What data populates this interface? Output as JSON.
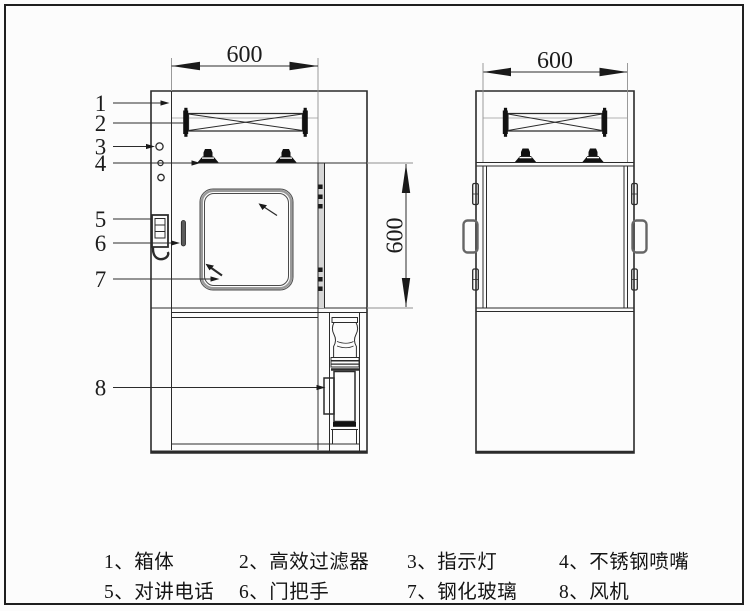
{
  "dimensions": {
    "front_width": "600",
    "front_height": "600",
    "side_width": "600"
  },
  "callouts": [
    "1",
    "2",
    "3",
    "4",
    "5",
    "6",
    "7",
    "8"
  ],
  "legend": {
    "items": [
      "1、箱体",
      "2、高效过滤器",
      "3、指示灯",
      "4、不锈钢喷嘴",
      "5、对讲电话",
      "6、门把手",
      "7、钢化玻璃",
      "8、风机"
    ]
  },
  "colors": {
    "line": "#2b2b2b",
    "light_line": "#8f8f8f",
    "background": "#fcfcfc"
  }
}
